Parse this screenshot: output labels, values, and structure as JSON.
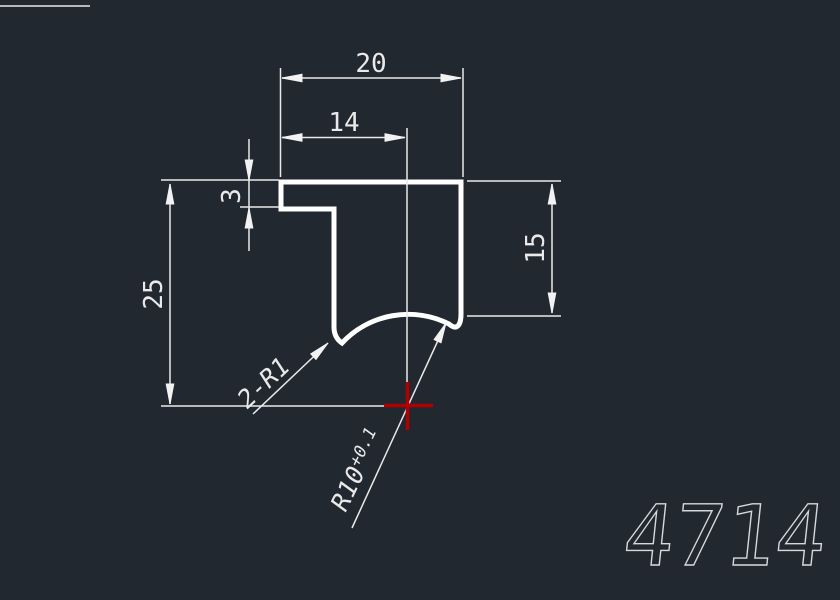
{
  "canvas": {
    "background_color": "#212830",
    "outline_color": "#ffffff",
    "dimension_color": "#e9e9e9",
    "center_mark_color": "#b00000",
    "part_number_color": "#d6d9dc"
  },
  "dimensions": {
    "top_width": "20",
    "inner_width": "14",
    "lip_thickness": "3",
    "left_height": "25",
    "right_height": "15"
  },
  "leaders": {
    "fillet_count_radius": "2-R1",
    "arc_radius": "R10",
    "arc_radius_tolerance": "+0.1"
  },
  "part_number": "4714"
}
